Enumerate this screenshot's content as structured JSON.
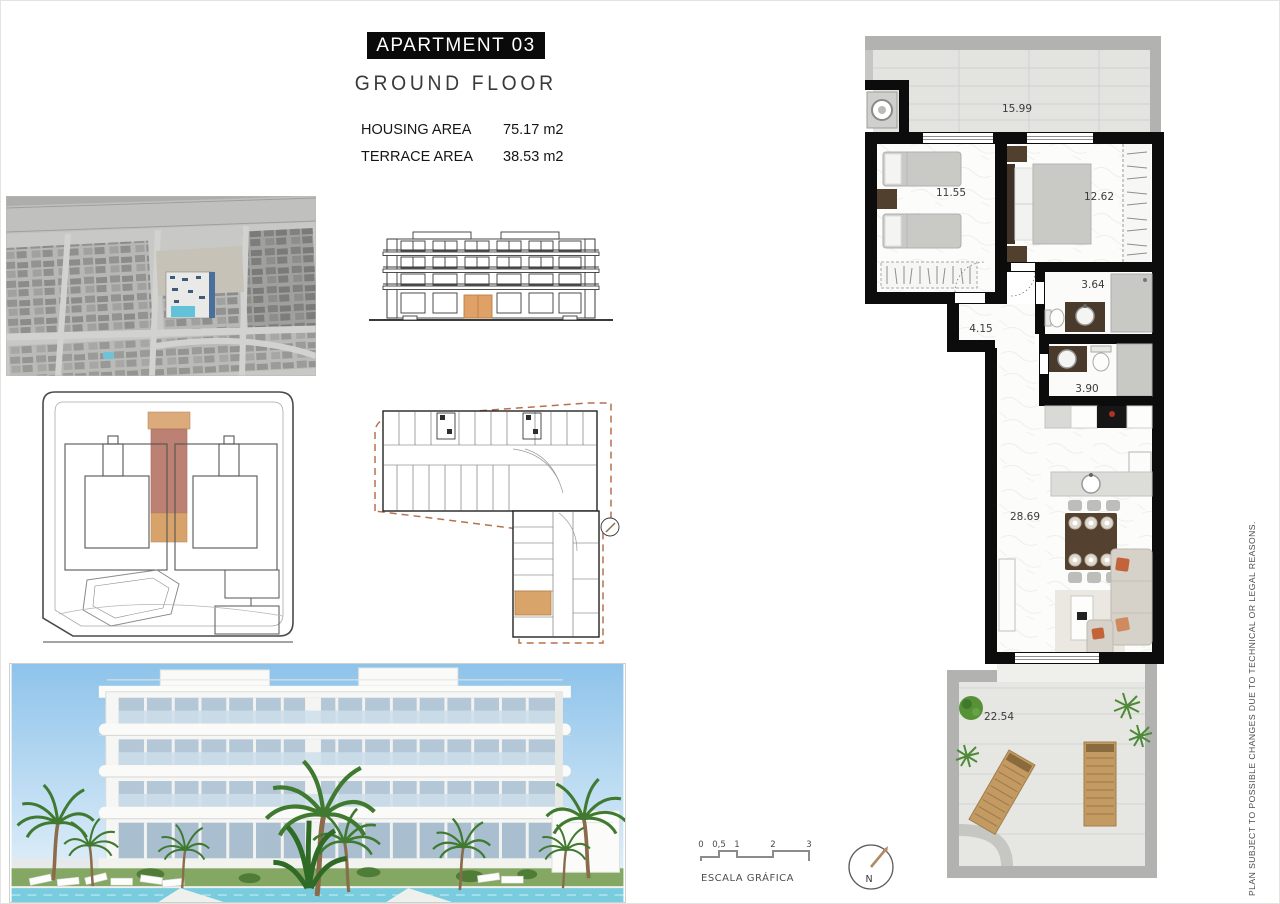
{
  "header": {
    "apartment_title": "APARTMENT 03",
    "floor_title": "GROUND FLOOR",
    "housing_area": {
      "label": "HOUSING AREA",
      "value": "75.17 m2"
    },
    "terrace_area": {
      "label": "TERRACE AREA",
      "value": "38.53 m2"
    }
  },
  "plan": {
    "rooms": {
      "terrace_top": "15.99",
      "bedroom_1": "11.55",
      "bedroom_2": "12.62",
      "bathroom_1": "3.64",
      "hallway": "4.15",
      "bathroom_2": "3.90",
      "living_room": "28.69",
      "terrace_bottom": "22.54"
    }
  },
  "scale_bar": {
    "ticks": [
      "0",
      "0,5",
      "1",
      "2",
      "3"
    ],
    "label": "ESCALA GRÁFICA"
  },
  "compass": {
    "north_label": "N"
  },
  "disclaimer": {
    "text": "PLAN SUBJECT TO POSSIBLE CHANGES DUE TO TECHNICAL OR LEGAL REASONS."
  },
  "colors": {
    "wall": "#0c0c0c",
    "highlight_tan": "#DCA87A",
    "highlight_rose": "#BC8172",
    "terrace_floor": "#E3E3E0",
    "pool": "#6EC6DC"
  }
}
